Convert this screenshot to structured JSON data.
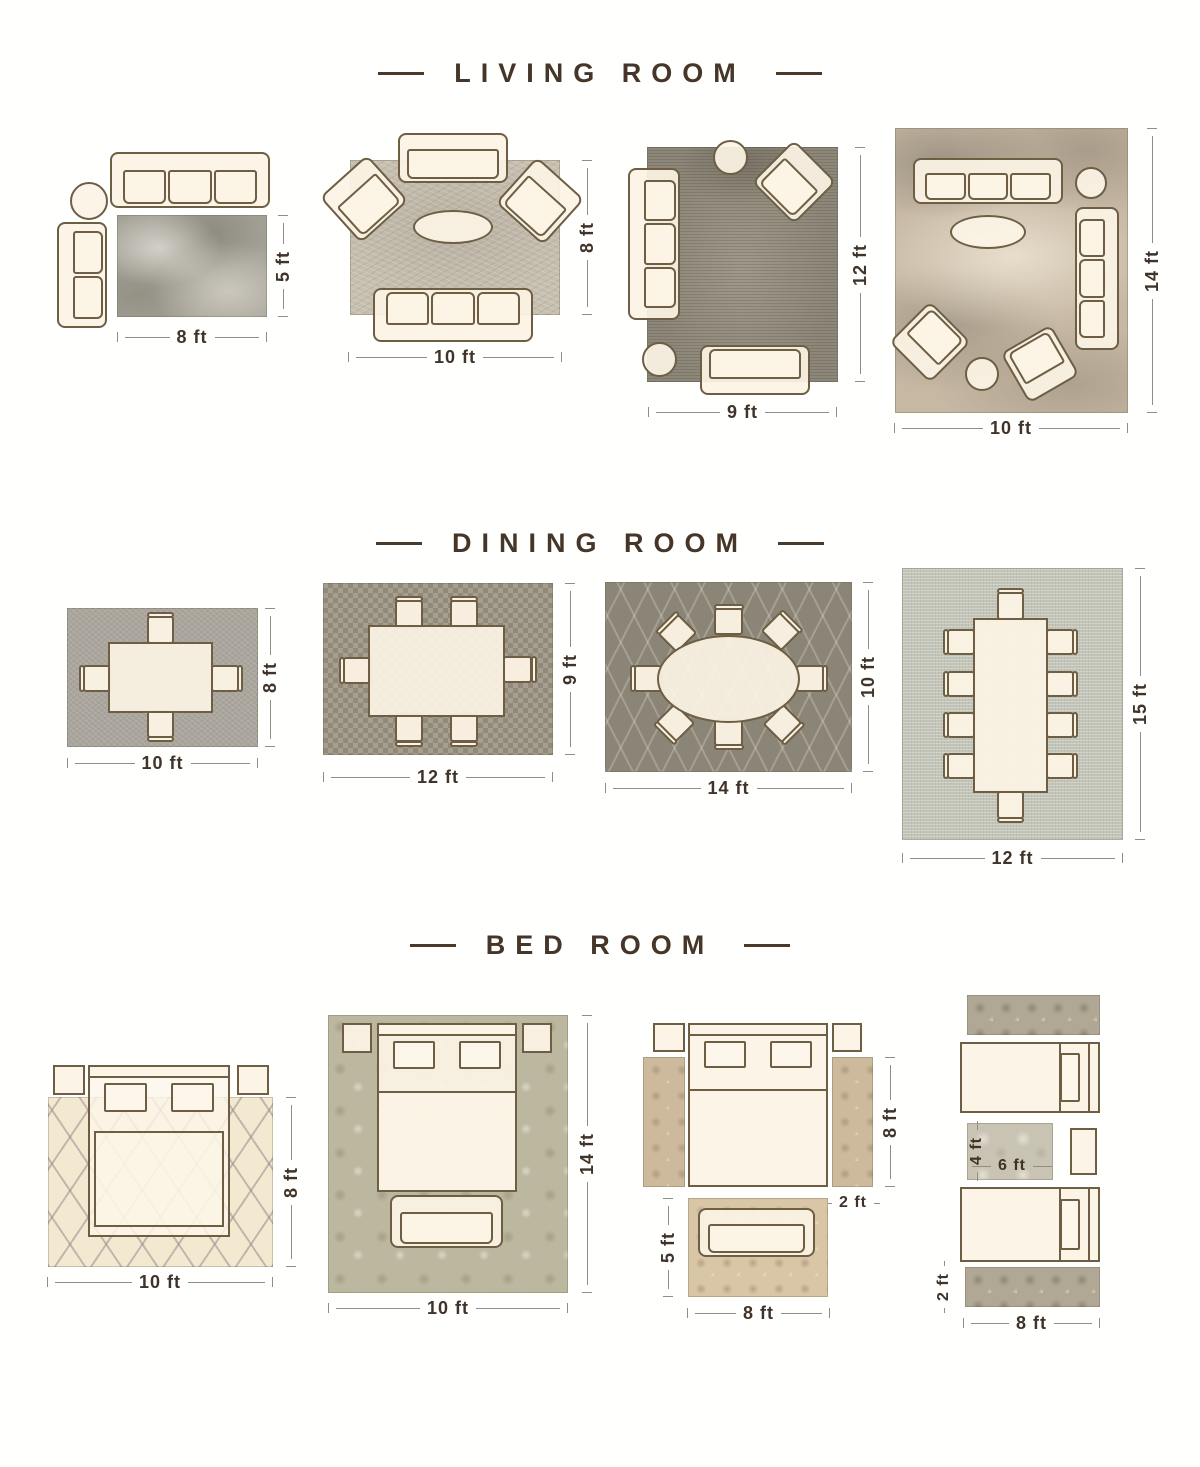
{
  "palette": {
    "title_brown": "#463629",
    "dimension_text": "#3f332a",
    "furniture_outline": "#6d5e44",
    "furniture_fill": "#fcf4e5",
    "rug_gray": "#a3a096",
    "rug_beige": "#c6b8a3",
    "rug_dark_gray": "#8b8577",
    "rug_cream": "#f3e9d1"
  },
  "sections": [
    {
      "title": "LIVING ROOM",
      "layouts": [
        {
          "name": "living-room-8x5",
          "width_label": "8 ft",
          "height_label": "5 ft"
        },
        {
          "name": "living-room-10x8",
          "width_label": "10 ft",
          "height_label": "8 ft"
        },
        {
          "name": "living-room-9x12",
          "width_label": "9 ft",
          "height_label": "12 ft"
        },
        {
          "name": "living-room-10x14",
          "width_label": "10 ft",
          "height_label": "14 ft"
        }
      ]
    },
    {
      "title": "DINING ROOM",
      "layouts": [
        {
          "name": "dining-room-10x8",
          "width_label": "10 ft",
          "height_label": "8 ft"
        },
        {
          "name": "dining-room-12x9",
          "width_label": "12 ft",
          "height_label": "9 ft"
        },
        {
          "name": "dining-room-14x10",
          "width_label": "14 ft",
          "height_label": "10 ft"
        },
        {
          "name": "dining-room-12x15",
          "width_label": "12 ft",
          "height_label": "15 ft"
        }
      ]
    },
    {
      "title": "BED ROOM",
      "layouts": [
        {
          "name": "bed-room-10x8",
          "width_label": "10 ft",
          "height_label": "8 ft"
        },
        {
          "name": "bed-room-10x14",
          "width_label": "10 ft",
          "height_label": "14 ft"
        },
        {
          "name": "bed-room-side-runners",
          "runner_length_label": "8 ft",
          "runner_width_label": "2 ft",
          "foot_rug_width_label": "8 ft",
          "foot_rug_height_label": "5 ft"
        },
        {
          "name": "bed-room-twin-beds",
          "between_rug_height_label": "4 ft",
          "between_rug_width_label": "6 ft",
          "runner_width_label": "2 ft",
          "runner_length_label": "8 ft"
        }
      ]
    }
  ]
}
